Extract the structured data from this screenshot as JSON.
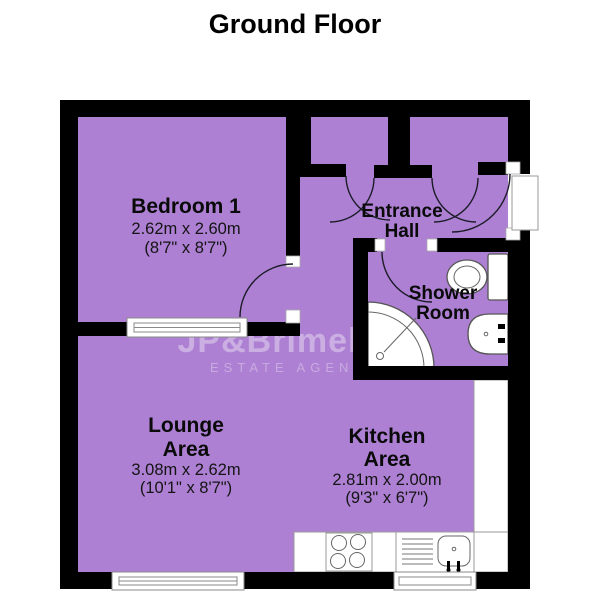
{
  "title": "Ground Floor",
  "watermark": {
    "brand": "JP&Brimel",
    "tagline": "ESTATE AGENTS"
  },
  "colors": {
    "room_fill": "#AD80D3",
    "wall": "#000000",
    "background": "#FFFFFF"
  },
  "rooms": {
    "bedroom1": {
      "name": "Bedroom 1",
      "metric": "2.62m x 2.60m",
      "imperial": "(8'7\" x 8'7\")"
    },
    "entrance_hall": {
      "line1": "Entrance",
      "line2": "Hall"
    },
    "shower_room": {
      "line1": "Shower",
      "line2": "Room"
    },
    "lounge": {
      "line1": "Lounge",
      "line2": "Area",
      "metric": "3.08m x 2.62m",
      "imperial": "(10'1\" x 8'7\")"
    },
    "kitchen": {
      "line1": "Kitchen",
      "line2": "Area",
      "metric": "2.81m x 2.00m",
      "imperial": "(9'3\" x 6'7\")"
    }
  }
}
